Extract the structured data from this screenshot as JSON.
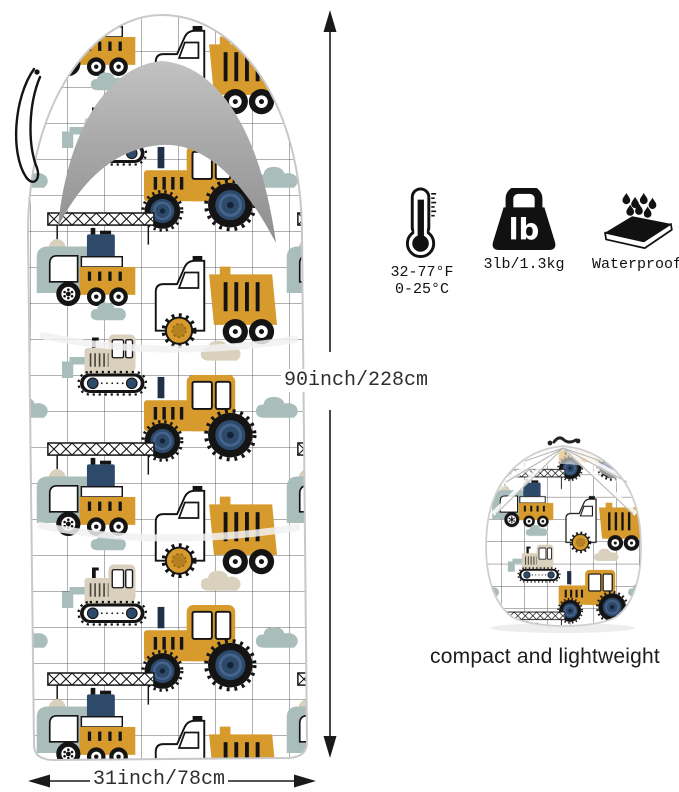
{
  "product_image": {
    "type": "kids sleeping bag with construction-vehicle grid print",
    "pattern_motifs": [
      "bulldozer",
      "tractor",
      "crane-truck",
      "dump-truck",
      "clouds",
      "grid"
    ]
  },
  "dimensions": {
    "vertical": "90inch/228cm",
    "horizontal": "31inch/78cm"
  },
  "features": {
    "temperature": {
      "icon": "thermometer-icon",
      "line1": "32-77°F",
      "line2": "0-25°C"
    },
    "weight": {
      "icon": "weight-icon",
      "icon_text": "lb",
      "label": "3lb/1.3kg"
    },
    "waterproof": {
      "icon": "waterproof-icon",
      "label": "Waterproof"
    }
  },
  "caption": {
    "text": "compact and lightweight"
  },
  "colors": {
    "mustard": "#d69a2d",
    "navy_wheel": "#2e4a6b",
    "blue_gray": "#a9bdba",
    "beige": "#d9d0bd",
    "hood_gray": "#a8a8a8",
    "outline_black": "#141414",
    "grid_line": "#3a3a3a",
    "arrow": "#1a1a1a"
  }
}
